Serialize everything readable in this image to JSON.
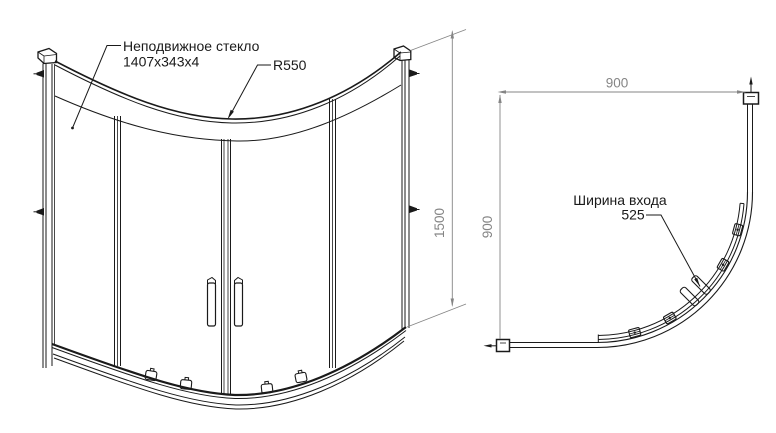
{
  "drawing": {
    "front_view": {
      "fixed_glass_label": "Неподвижное стекло",
      "fixed_glass_size": "1407x343x4",
      "radius_label": "R550",
      "height_dim": "1500"
    },
    "plan_view": {
      "width_dim": "900",
      "depth_dim": "900",
      "entry_width_label": "Ширина входа",
      "entry_width_value": "525"
    },
    "colors": {
      "line": "#1a1a1a",
      "dimension": "#858585",
      "background": "#ffffff"
    }
  }
}
